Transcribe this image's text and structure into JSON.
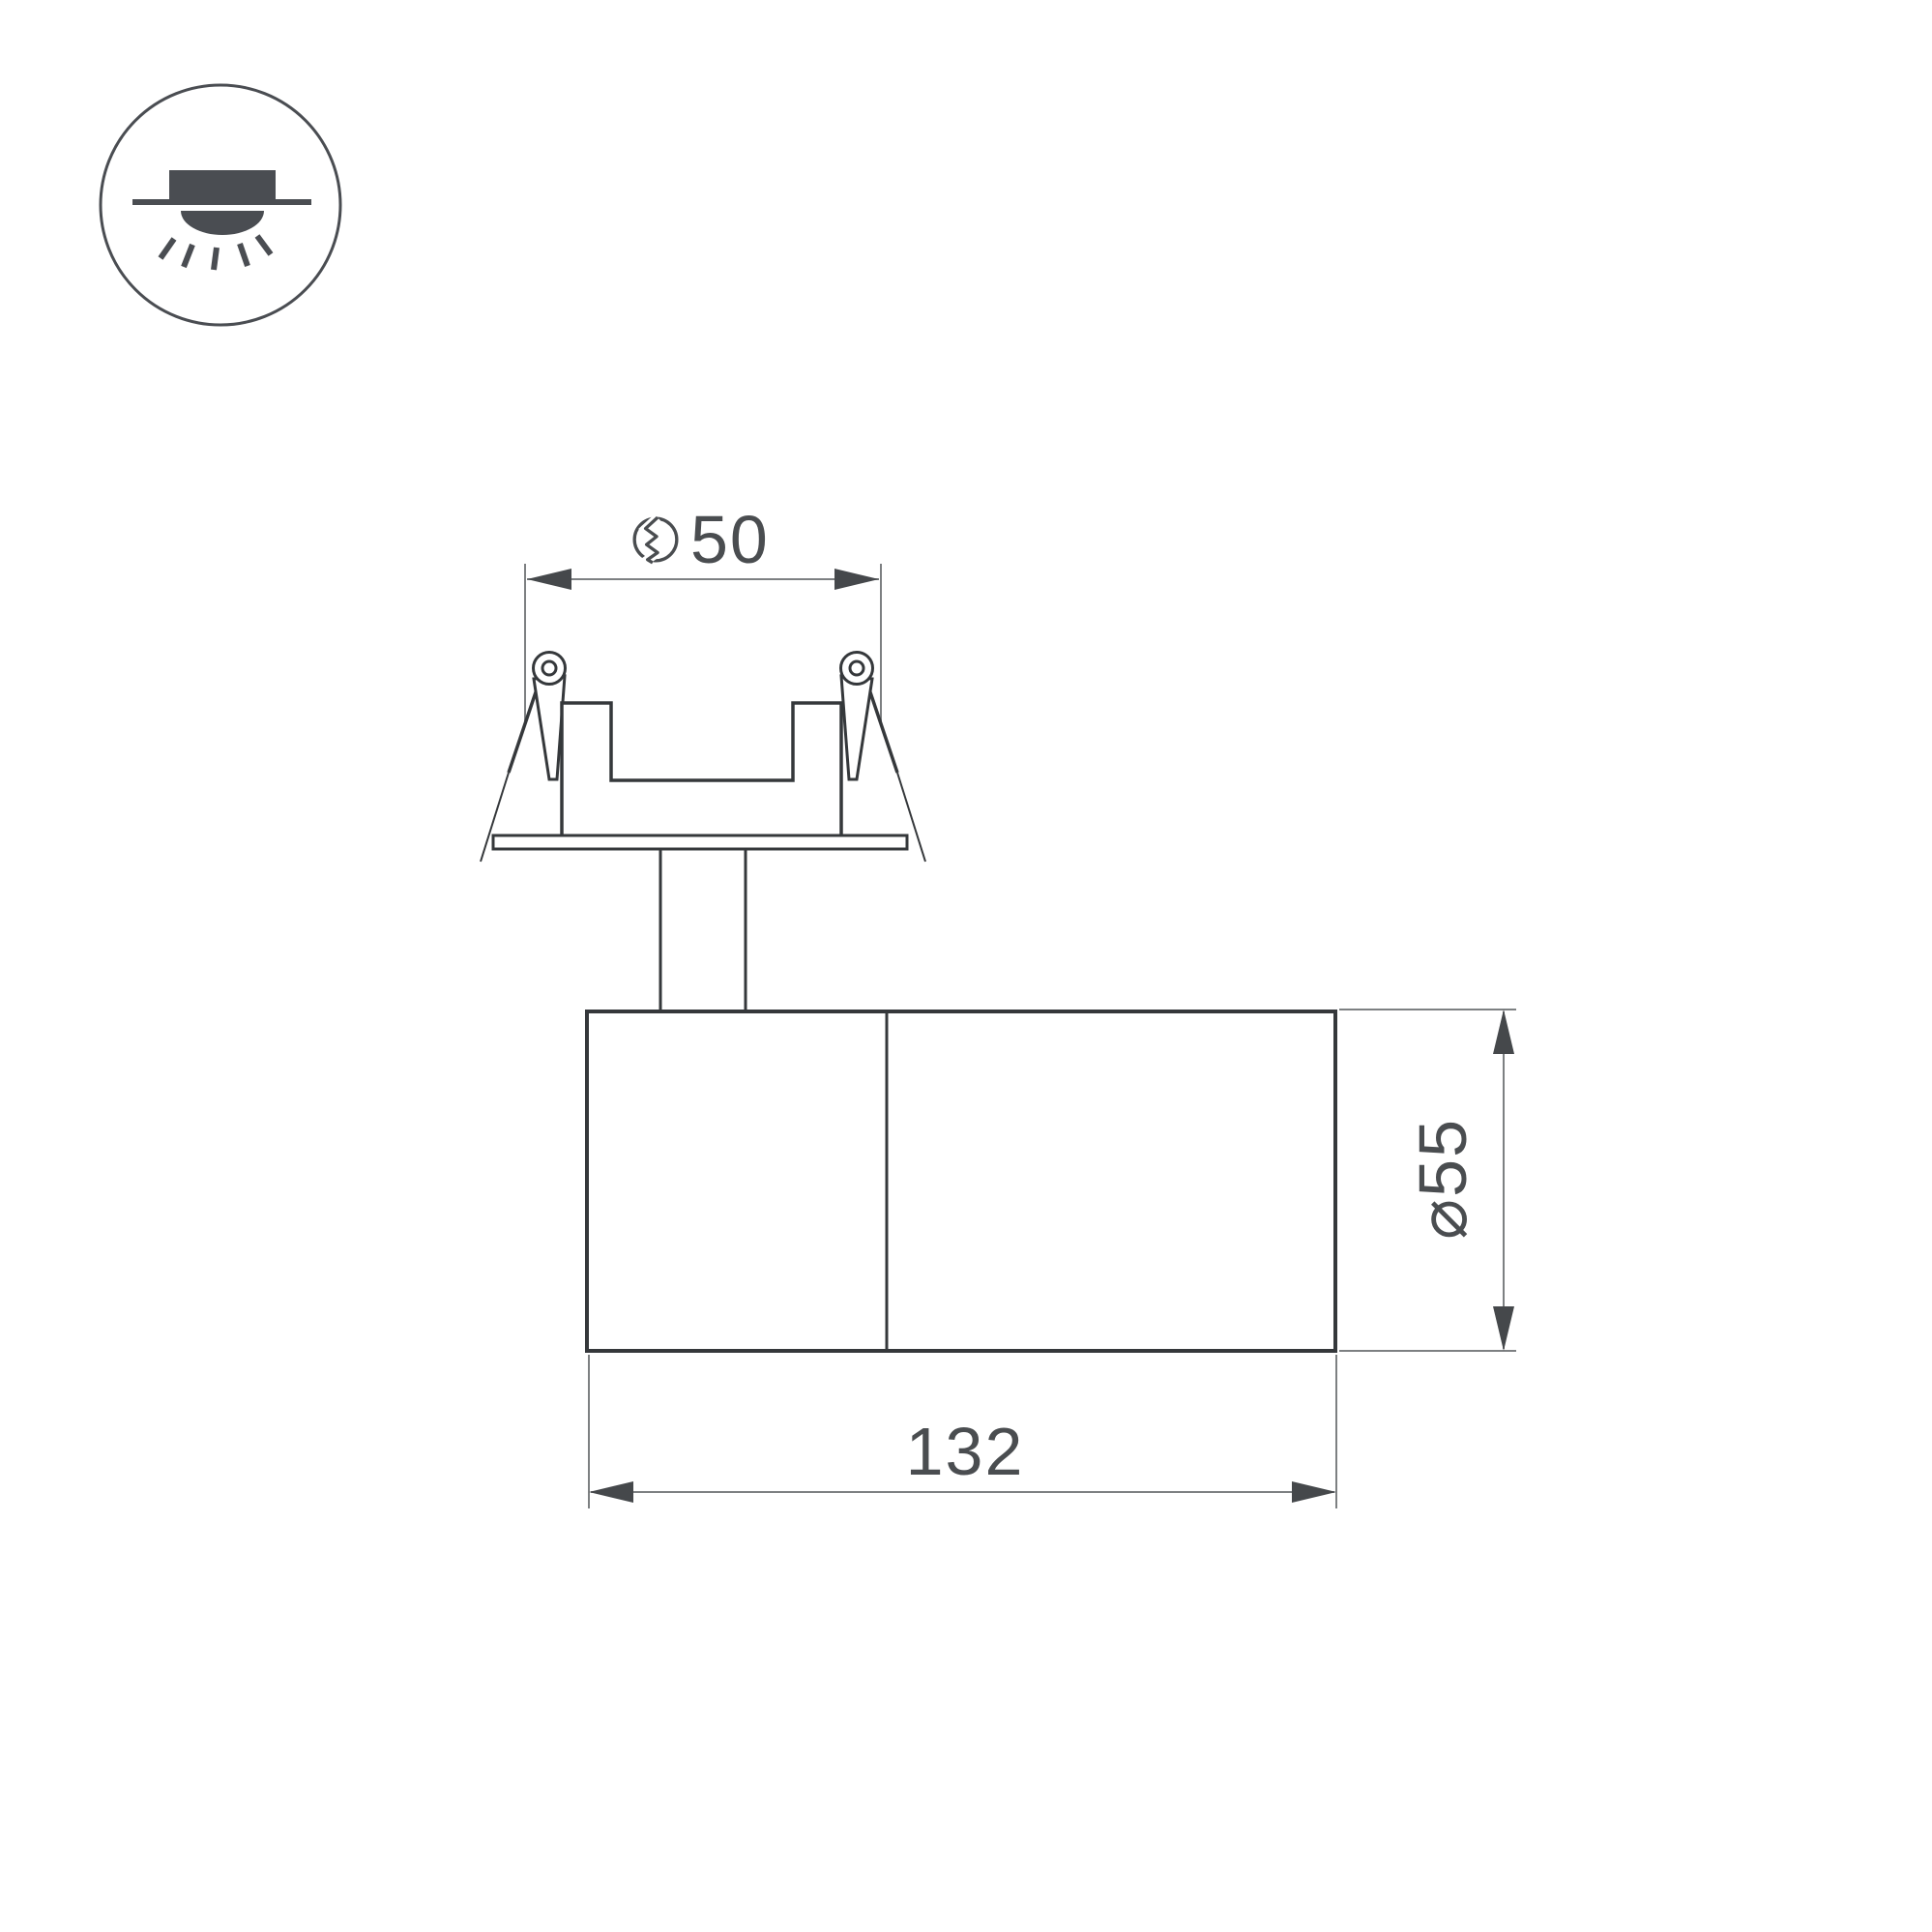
{
  "drawing": {
    "views": {
      "badge": "recessed-downlight-icon",
      "main": "recessed-swivel-spot-side-view"
    }
  },
  "dimensions": {
    "cutout": {
      "symbol": "hole-cut-symbol",
      "value": "50"
    },
    "diameter": {
      "label": "⌀55"
    },
    "length": {
      "value": "132"
    }
  },
  "colors": {
    "background": "#ffffff",
    "line": "#35383b",
    "dimension": "#7d8082",
    "arrow": "#45484b",
    "text": "#4a4d50",
    "icon": "#4a4d52"
  }
}
